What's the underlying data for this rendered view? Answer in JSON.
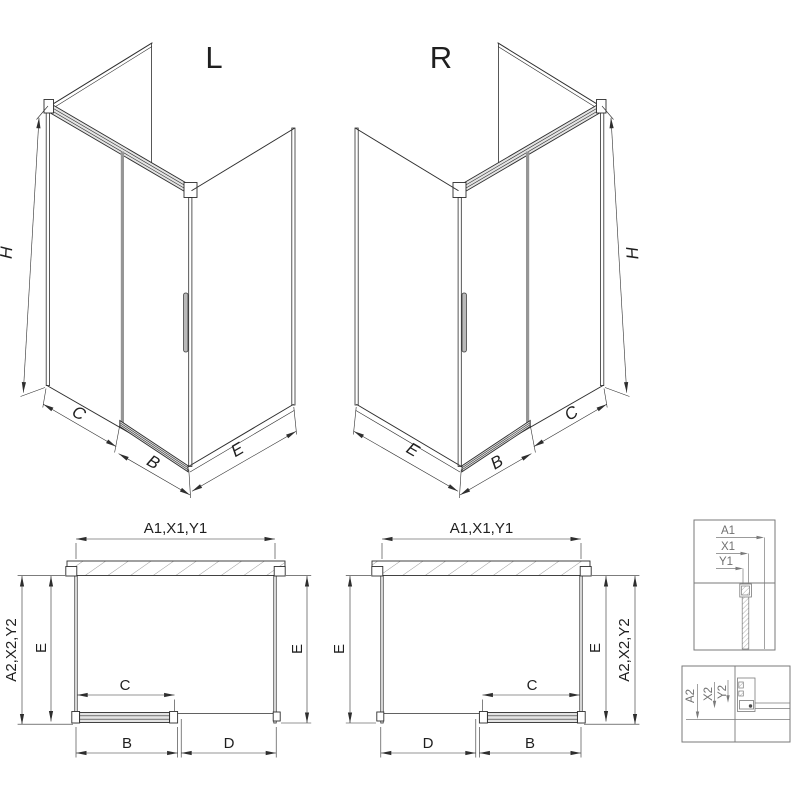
{
  "drawing": {
    "iso_left": {
      "label": "L",
      "dim_height": "H",
      "dim_fixed": "C",
      "dim_door": "B",
      "dim_side": "E"
    },
    "iso_right": {
      "label": "R",
      "dim_height": "H",
      "dim_fixed": "C",
      "dim_door": "B",
      "dim_side": "E"
    },
    "plan_left": {
      "dim_width_top": "A1,X1,Y1",
      "dim_depth_outer": "A2,X2,Y2",
      "dim_depth_inner": "E",
      "dim_depth_far": "E",
      "dim_fixed": "C",
      "dim_door": "B",
      "dim_opening": "D"
    },
    "plan_right": {
      "dim_width_top": "A1,X1,Y1",
      "dim_depth_outer": "A2,X2,Y2",
      "dim_depth_inner": "E",
      "dim_depth_far": "E",
      "dim_fixed": "C",
      "dim_door": "B",
      "dim_opening": "D"
    },
    "detail_wall_profile": {
      "dim_a": "A1",
      "dim_x": "X1",
      "dim_y": "Y1"
    },
    "detail_floor_profile": {
      "dim_a": "A2",
      "dim_x": "X2",
      "dim_y": "Y2"
    }
  },
  "colors": {
    "line": "#2e2e2e",
    "line_gray": "#969696",
    "rail": "#e4e4e4",
    "detail": "#7a7a7a",
    "text": "#1f1f1f",
    "detail_text": "#707070",
    "hatch": "#6f6f6f",
    "background": "#ffffff"
  }
}
